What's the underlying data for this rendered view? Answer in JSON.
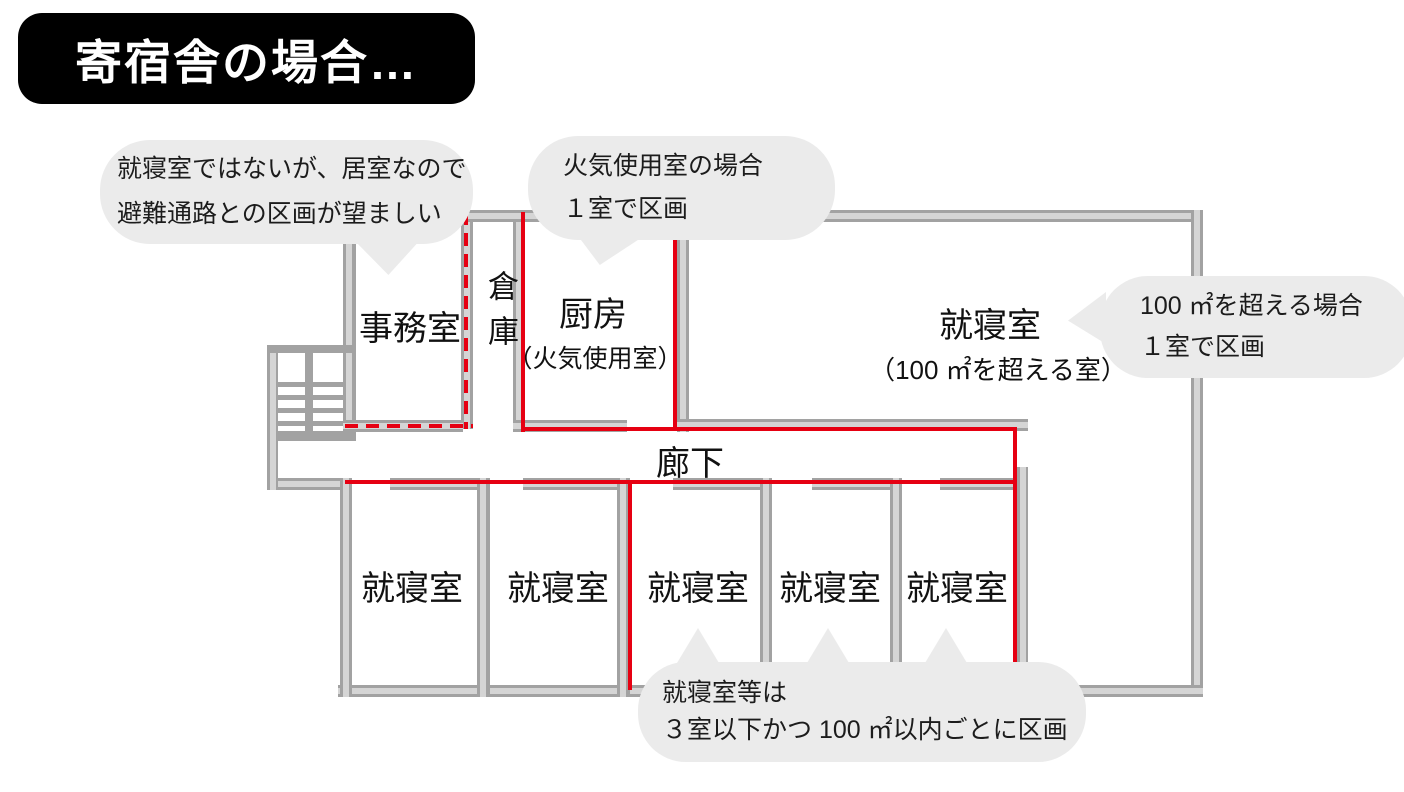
{
  "title": "寄宿舎の場合…",
  "colors": {
    "compartment_red": "#e60012",
    "wall_gray": "#a2a2a2",
    "wall_core": "#d5d5d5",
    "bubble_gray": "#ebebeb",
    "title_bg": "#000000",
    "title_text": "#ffffff"
  },
  "callouts": {
    "office": {
      "line1": "就寝室ではないが、居室なので",
      "line2": "避難通路との区画が望ましい"
    },
    "kitchen": {
      "line1": "火気使用室の場合",
      "line2": "１室で区画"
    },
    "large_bedroom": {
      "line1": "100 ㎡を超える場合",
      "line2": "１室で区画"
    },
    "bedrooms": {
      "line1": "就寝室等は",
      "line2": "３室以下かつ 100 ㎡以内ごとに区画"
    }
  },
  "rooms": {
    "office": "事務室",
    "storage": "倉庫",
    "kitchen": "厨房",
    "kitchen_sub": "（火気使用室）",
    "large_bedroom": "就寝室",
    "large_bedroom_sub": "（100 ㎡を超える室）",
    "corridor": "廊下",
    "bedrooms": [
      "就寝室",
      "就寝室",
      "就寝室",
      "就寝室",
      "就寝室"
    ]
  }
}
